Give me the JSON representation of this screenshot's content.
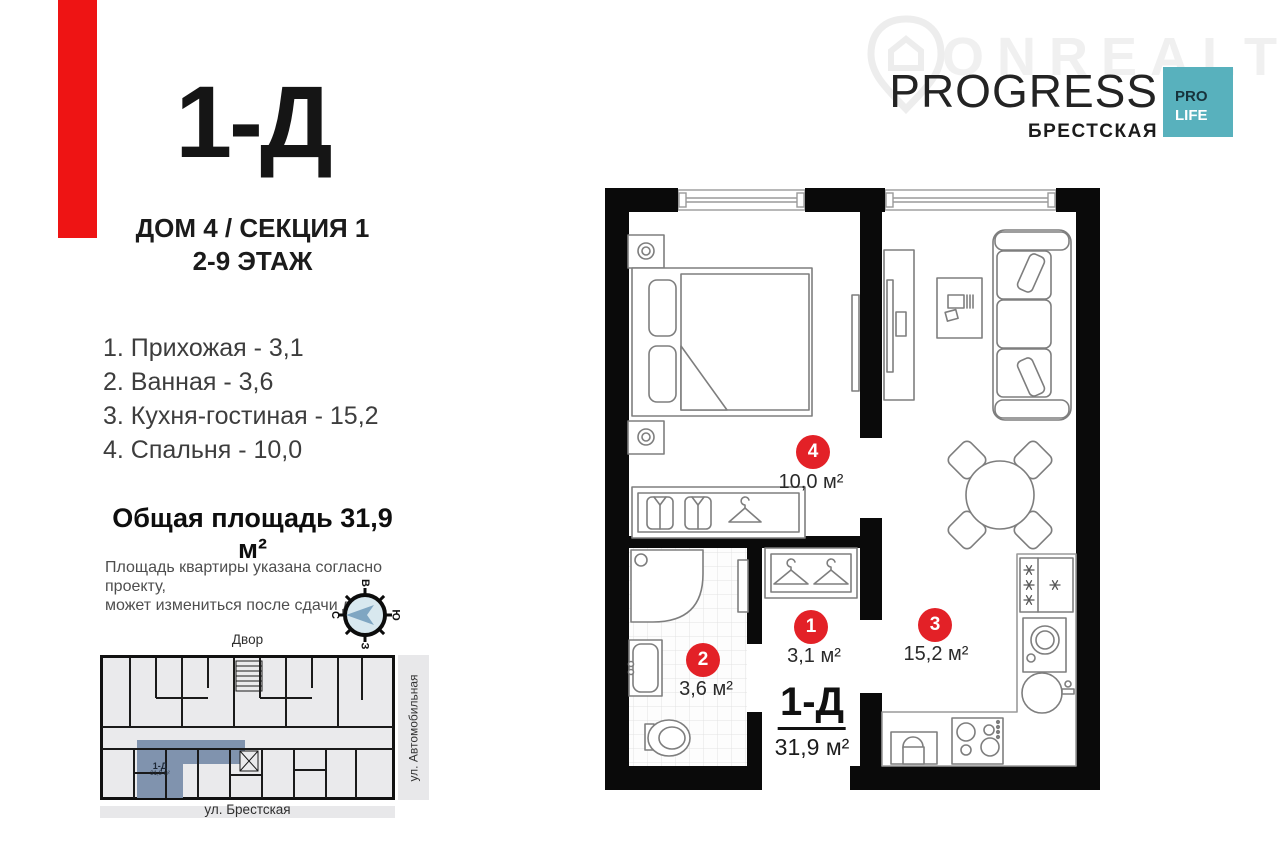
{
  "title": {
    "unit": "1-Д",
    "line1": "ДОМ 4 / СЕКЦИЯ 1",
    "line2": "2-9 ЭТАЖ"
  },
  "rooms": [
    {
      "num": "1",
      "name": "Прихожая",
      "list_label": "1. Прихожая - 3,1",
      "area_label": "3,1 м²"
    },
    {
      "num": "2",
      "name": "Ванная",
      "list_label": "2. Ванная - 3,6",
      "area_label": "3,6 м²"
    },
    {
      "num": "3",
      "name": "Кухня-гостиная",
      "list_label": "3. Кухня-гостиная - 15,2",
      "area_label": "15,2 м²"
    },
    {
      "num": "4",
      "name": "Спальня",
      "list_label": "4. Спальня - 10,0",
      "area_label": "10,0 м²"
    }
  ],
  "total_area_label": "Общая площадь 31,9 м²",
  "disclaimer_line1": "Площадь квартиры указана согласно проекту,",
  "disclaimer_line2": "может измениться после сдачи дома",
  "plan_label": {
    "unit": "1-Д",
    "area": "31,9 м²"
  },
  "compass": {
    "top": "В",
    "right": "Ю",
    "bottom": "З",
    "left": "С"
  },
  "minimap": {
    "top_label": "Двор",
    "right_label": "ул. Автомобильная",
    "bottom_label": "ул. Брестская",
    "unit": "1-Д",
    "unit_area": "31,9 м²"
  },
  "brand": {
    "watermark": "ONREALT",
    "name": "PROGRESS",
    "location": "БРЕСТСКАЯ",
    "badge_top": "PRO",
    "badge_bottom": "LIFE"
  },
  "colors": {
    "accent_red": "#ee1414",
    "badge_red": "#e32127",
    "teal": "#58b1bd",
    "unit_blue": "#8093ae",
    "wall_black": "#0a0a0a"
  }
}
